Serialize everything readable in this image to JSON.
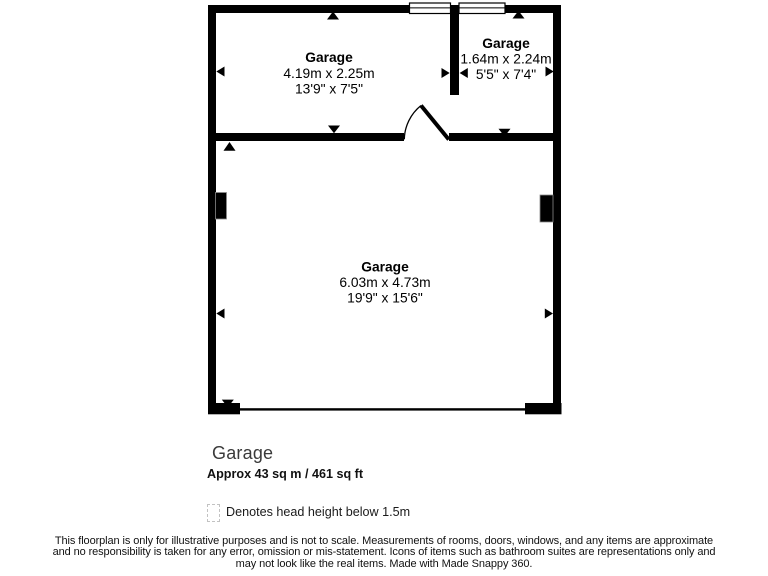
{
  "floorplan": {
    "rooms": [
      {
        "name": "Garage",
        "dims_metric": "4.19m x 2.25m",
        "dims_imperial": "13'9\" x 7'5\""
      },
      {
        "name": "Garage",
        "dims_metric": "1.64m x 2.24m",
        "dims_imperial": "5'5\" x 7'4\""
      },
      {
        "name": "Garage",
        "dims_metric": "6.03m x 4.73m",
        "dims_imperial": "19'9\" x 15'6\""
      }
    ]
  },
  "summary": {
    "title": "Garage",
    "area": "Approx 43 sq m / 461 sq ft"
  },
  "legend": {
    "label": "Denotes head height below 1.5m"
  },
  "disclaimer": {
    "line1": "This floorplan is only for illustrative purposes and is not to scale. Measurements of rooms, doors, windows, and any items are approximate",
    "line2": "and no responsibility is taken for any error, omission or mis-statement. Icons of items such as bathroom suites are representations only and",
    "line3": "may not look like the real items. Made with Made Snappy 360."
  },
  "colors": {
    "wall": "#000000",
    "room_text": "#000000",
    "summary_title_text": "#3a3a3a",
    "legend_dash": "#c2c2c2"
  },
  "icons": {
    "window-symbol": "white bar with center mullion line",
    "door-swing-symbol": "quarter-arc with angled door leaf",
    "dimension-arrow": "small solid black triangle",
    "head-height-legend-box": "small dashed-outline square"
  }
}
